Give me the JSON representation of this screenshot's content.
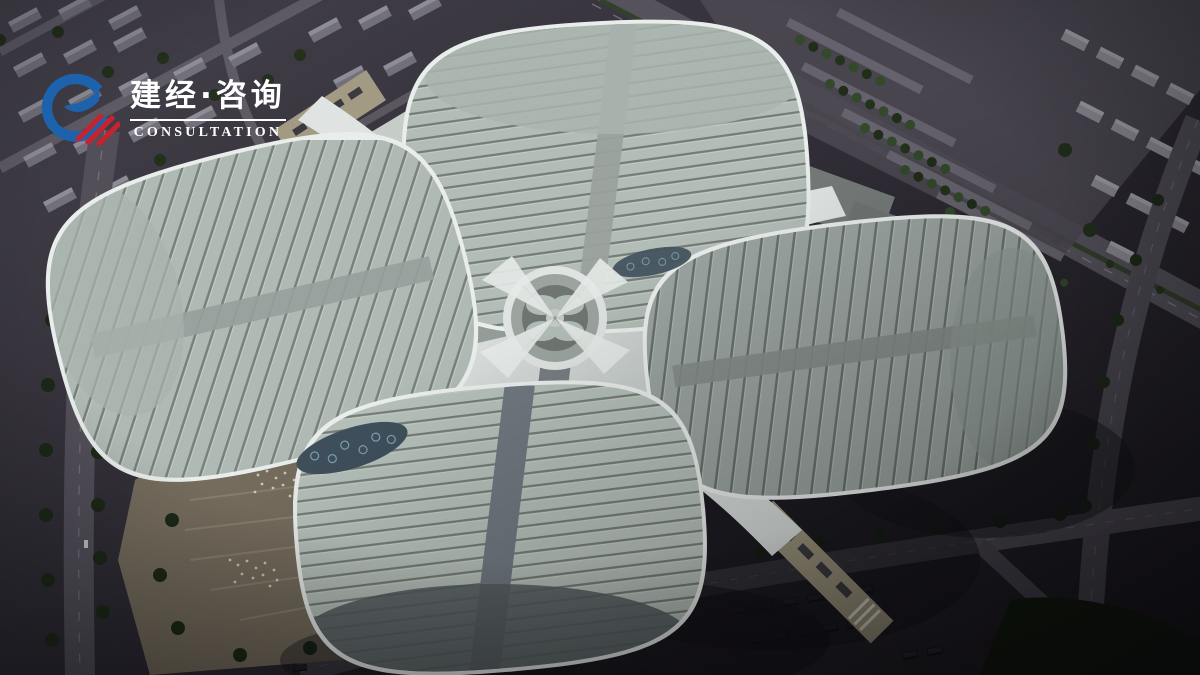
{
  "logo": {
    "brand_cn": "建经·咨询",
    "brand_en": "CONSULTATION",
    "icon": "ring-swoosh-stripes-logo",
    "colors": {
      "blue": "#1d62ac",
      "red": "#c5232f",
      "text": "#ffffff"
    }
  },
  "scene": {
    "type": "aerial architectural rendering",
    "description": "Dusk aerial rendering of a four-leaf-clover shaped exhibition and convention center: four striped oval hall roofs around a circular central hub joined by white canopies, with a stepped pedestrian plaza, footbridge, tree-lined parking lots, arterial roads and city blocks around it",
    "palette": {
      "roof_light": "#b5c0ba",
      "roof_stripe": "#757e78",
      "roof_edge_white": "#e9edeb",
      "canopy_white": "#e6eae8",
      "ground_dark": "#2a272f",
      "road_gray": "#56535d",
      "tree_green": "#22301d",
      "plaza_tan": "#7b7263"
    }
  }
}
